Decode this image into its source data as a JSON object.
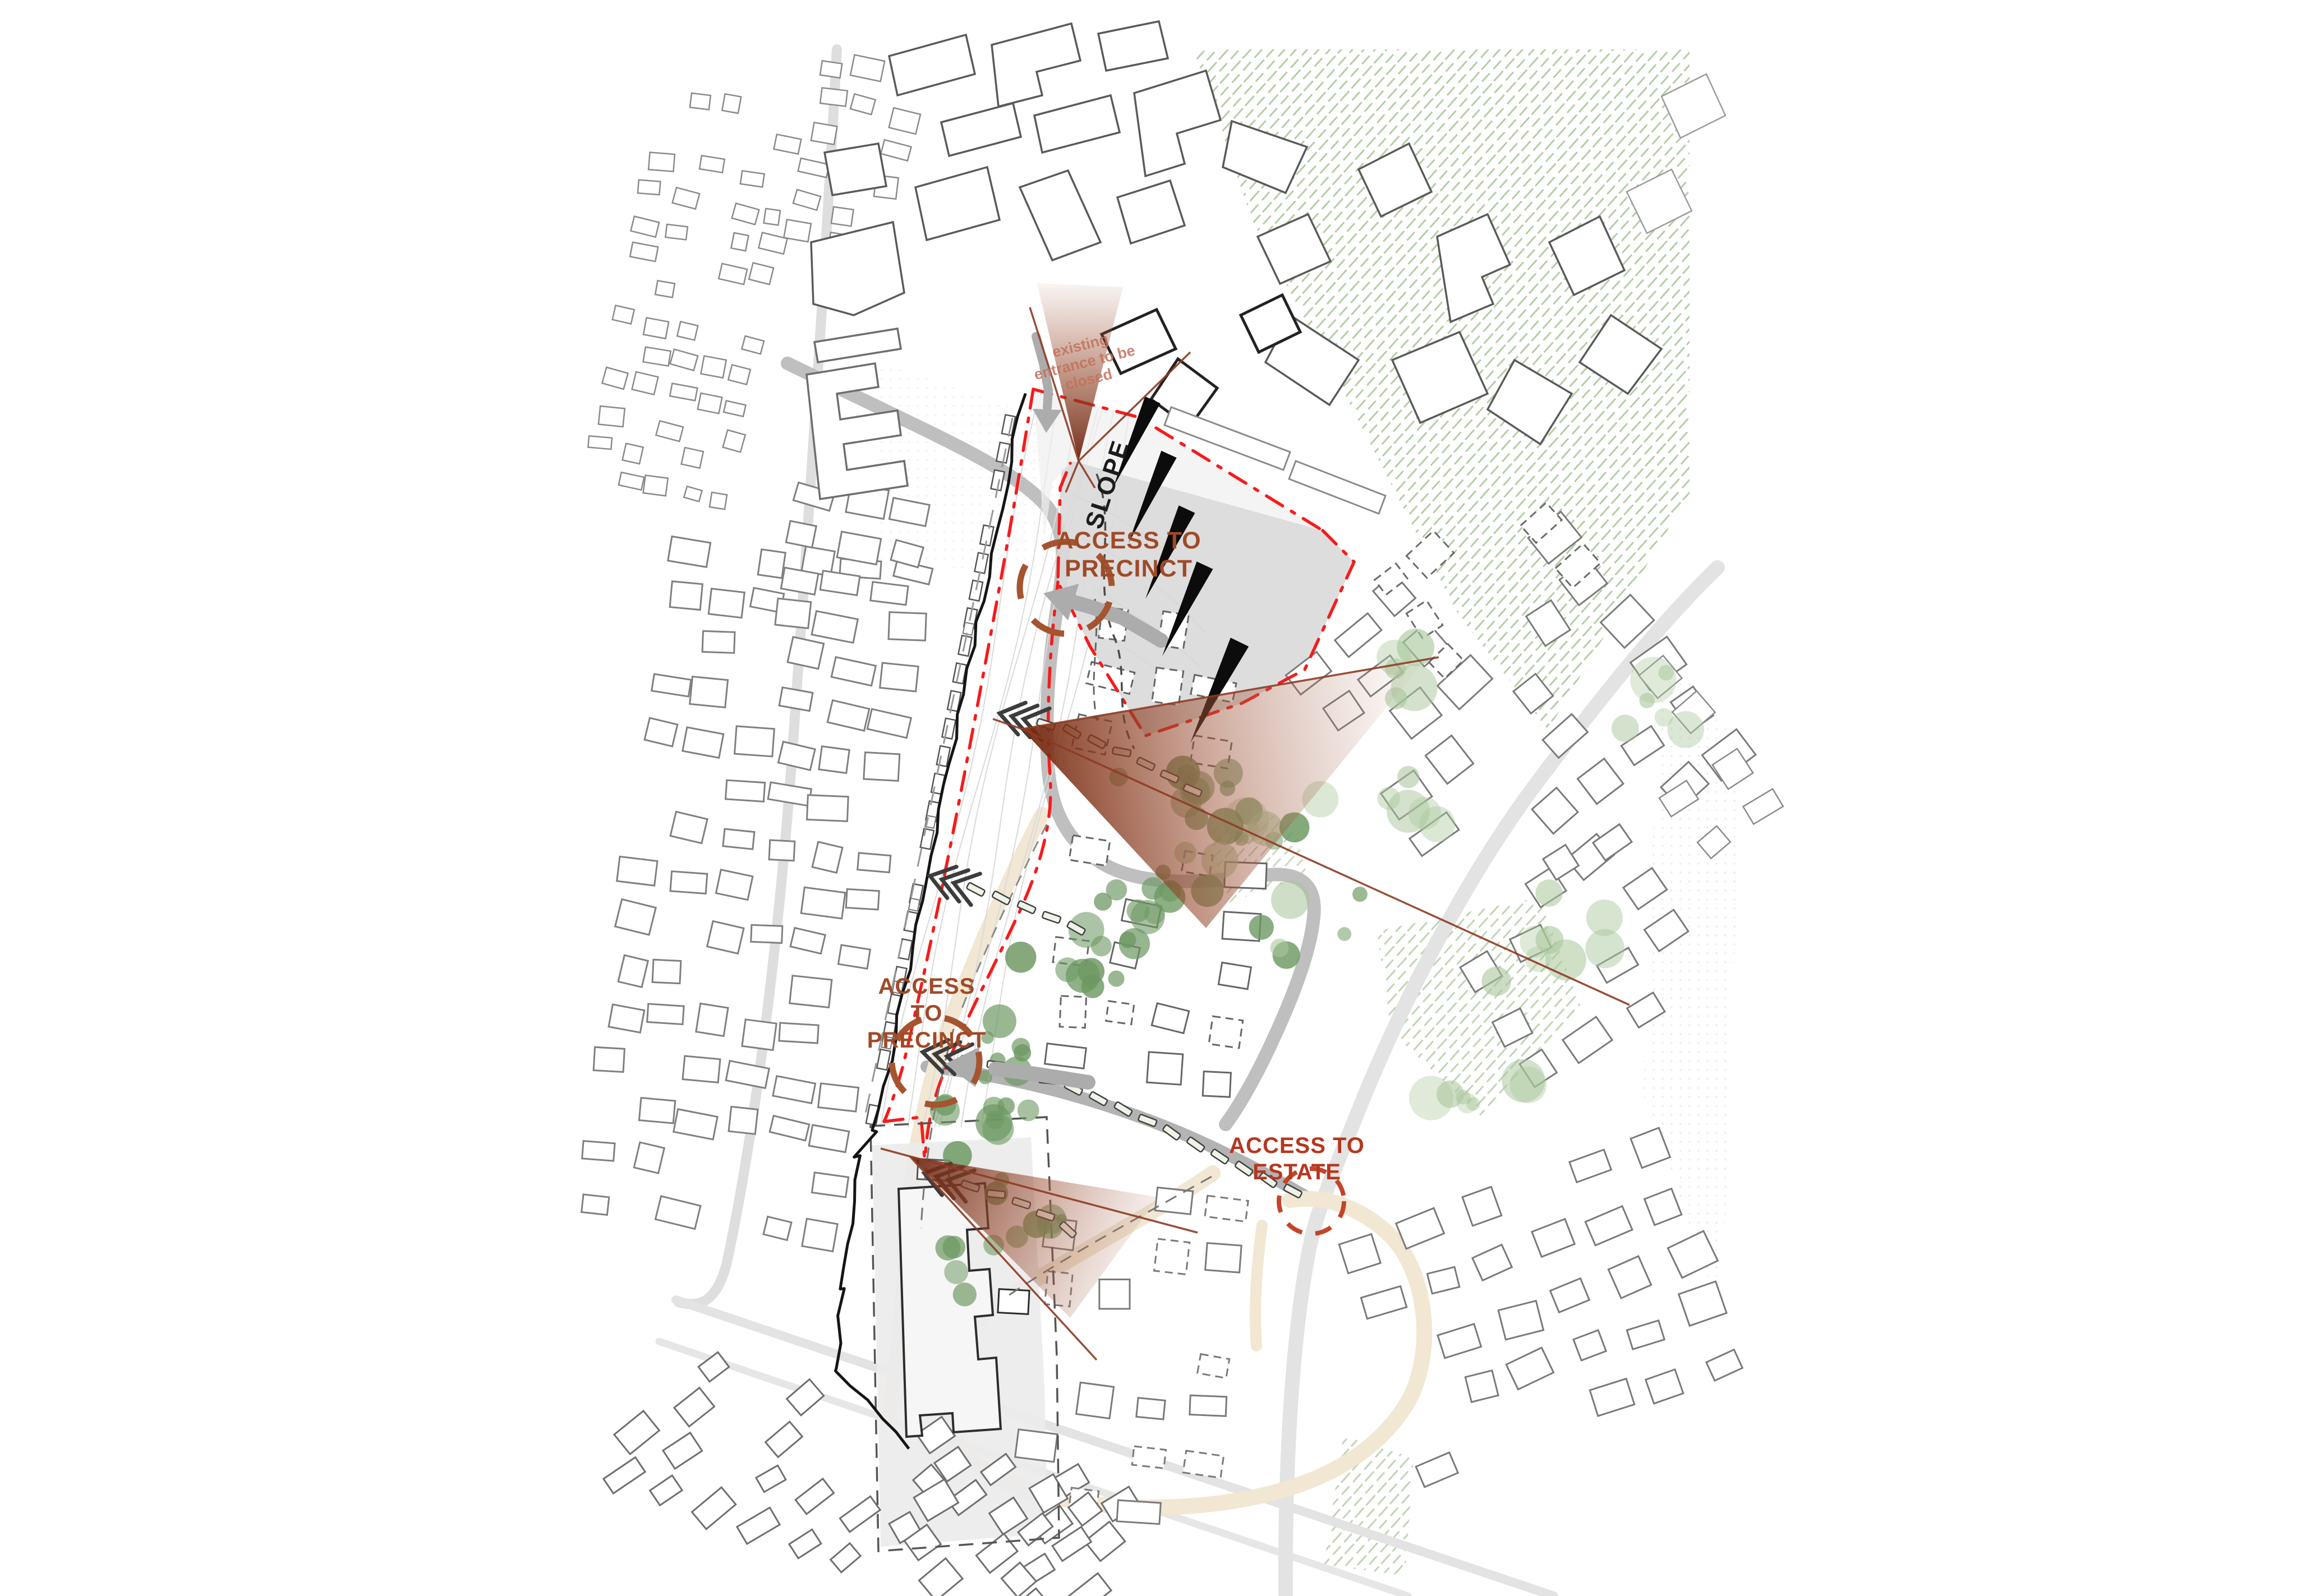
{
  "labels": {
    "existing_entrance": {
      "lines": [
        "existing",
        "entrance to be",
        "closed"
      ]
    },
    "slope": "SLOPE",
    "access_precinct_top": {
      "lines": [
        "ACCESS TO",
        "PRECINCT"
      ]
    },
    "access_precinct_mid": {
      "lines": [
        "ACCESS",
        "TO",
        "PRECINCT"
      ]
    },
    "access_estate": {
      "lines": [
        "ACCESS TO",
        "ESTATE"
      ]
    }
  },
  "markers": {
    "view_cones": 3,
    "slope_arrows": 5,
    "access_circles": [
      "precinct-top",
      "precinct-mid",
      "estate"
    ],
    "movement_arrow_icons": [
      "gray-entry-arrow-down",
      "gray-access-arrow-nw",
      "gray-access-arrow-west"
    ],
    "pedestrian_trail_icons": [
      "chevron-trail-1",
      "chevron-trail-2",
      "chevron-trail-3",
      "chevron-trail-4"
    ]
  },
  "colors": {
    "boundary_red": "#f71b1b",
    "cone_red": "#7c2c11",
    "label_brown": "#a04a28",
    "label_red": "#b5371f",
    "note_red": "#c4705a",
    "access_circle_brown": "#a5542f",
    "estate_circle_red": "#c44427",
    "tree_dark": "#6d9862",
    "tree_light": "#aac79c",
    "hatch_green": "#aecba0",
    "road_gray": "#bfbfbf",
    "road_light": "#e3e3e3",
    "path_beige": "#f1e7d2",
    "arrow_gray": "#acacac",
    "building_stroke": "#7a7a7a",
    "site_black": "#151515",
    "slope_fill": "#d9d9d9"
  }
}
